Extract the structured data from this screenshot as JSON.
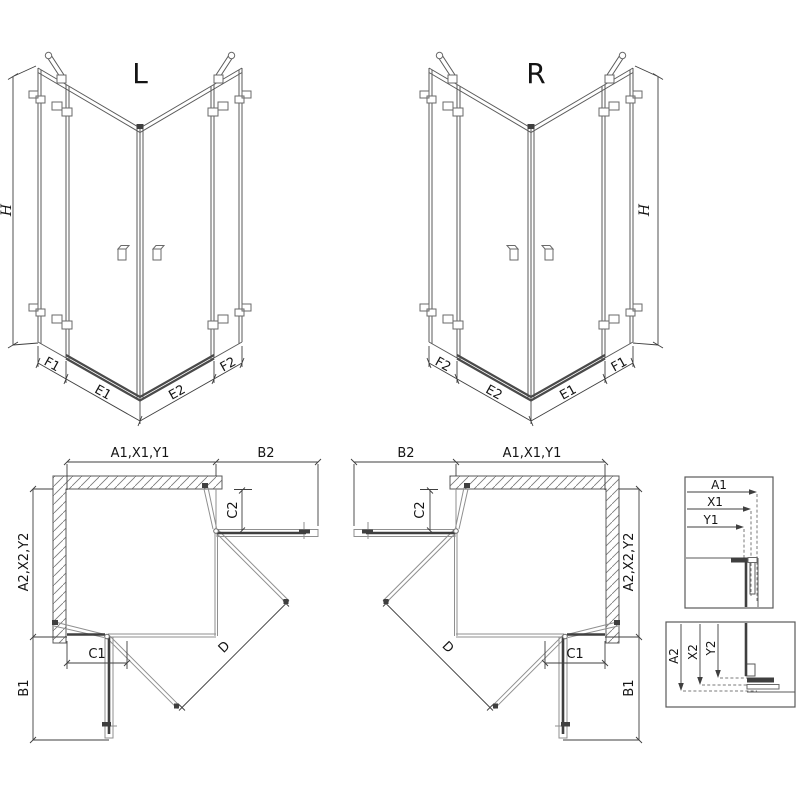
{
  "iso_left": {
    "title": "L",
    "height": "H",
    "widths": [
      "F1",
      "E1",
      "E2",
      "F2"
    ]
  },
  "iso_right": {
    "title": "R",
    "height": "H",
    "widths": [
      "F2",
      "E2",
      "E1",
      "F1"
    ]
  },
  "plan_left": {
    "top": "A1,X1,Y1",
    "top_side": "B2",
    "left": "A2,X2,Y2",
    "left_bottom": "B1",
    "strip_bottom": "C1",
    "strip_right": "C2",
    "diagonal": "D"
  },
  "plan_right": {
    "top": "A1,X1,Y1",
    "top_side": "B2",
    "right": "A2,X2,Y2",
    "right_bottom": "B1",
    "strip_bottom": "C1",
    "strip_left": "C2",
    "diagonal": "D"
  },
  "detail_width": {
    "rows": [
      "A1",
      "X1",
      "Y1"
    ]
  },
  "detail_height": {
    "rows": [
      "A2",
      "X2",
      "Y2"
    ]
  }
}
